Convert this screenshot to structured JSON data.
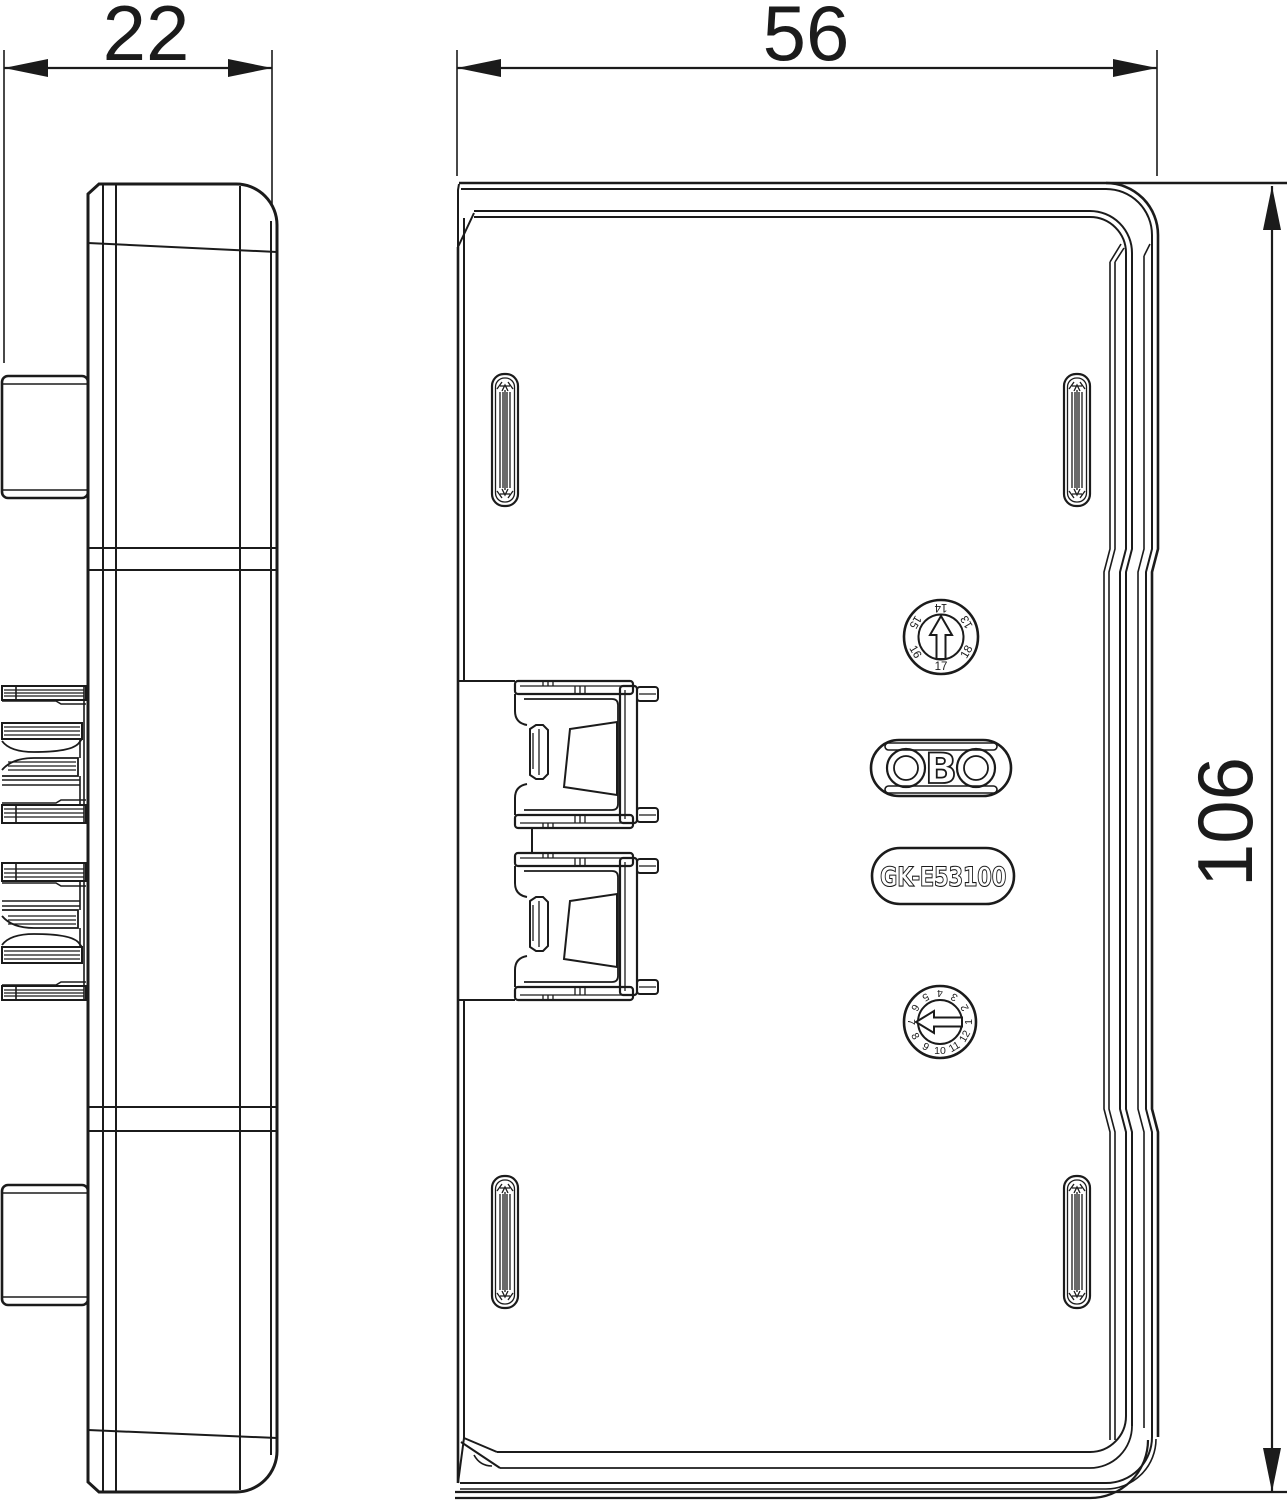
{
  "drawing": {
    "type": "technical-dimension-drawing",
    "views": [
      "side-view",
      "front-view"
    ],
    "line_color": "#1b1b1b",
    "background_color": "#ffffff"
  },
  "dimensions": {
    "side_width": "22",
    "front_width": "56",
    "front_height": "106"
  },
  "logo": {
    "name": "OBO",
    "letter_b": "B"
  },
  "part_label": {
    "code": "GK-E53100"
  },
  "dials": {
    "year": {
      "arrow_direction": "up",
      "numbers": [
        "14",
        "13",
        "18",
        "17",
        "16",
        "15"
      ]
    },
    "month": {
      "arrow_direction": "left",
      "numbers": [
        "4",
        "3",
        "2",
        "1",
        "12",
        "11",
        "10",
        "9",
        "8",
        "7",
        "6",
        "5"
      ]
    }
  }
}
